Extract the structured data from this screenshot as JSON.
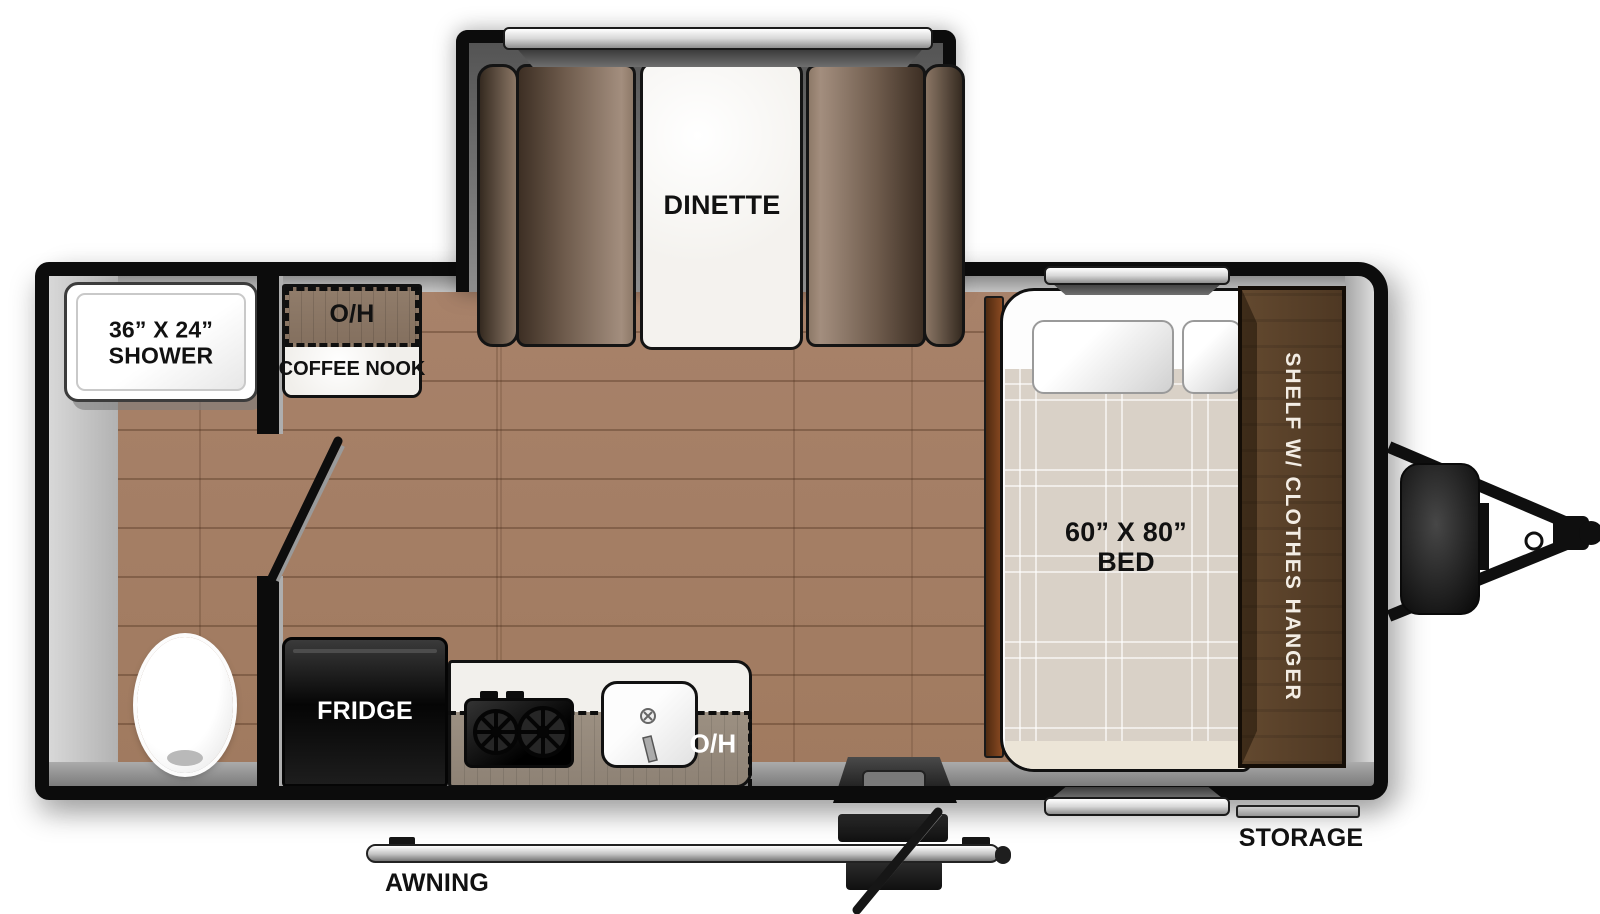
{
  "floorplan": {
    "slideout": {
      "dinette_label": "DINETTE"
    },
    "bathroom": {
      "shower_size": "36” X 24”",
      "shower_label": "SHOWER"
    },
    "coffee_nook": {
      "oh_label": "O/H",
      "label": "COFFEE NOOK"
    },
    "kitchen": {
      "fridge_label": "FRIDGE",
      "oh_label": "O/H"
    },
    "bedroom": {
      "bed_size": "60” X 80”",
      "bed_label": "BED",
      "shelf_label": "SHELF W/ CLOTHES HANGER",
      "storage_label": "STORAGE"
    },
    "exterior": {
      "awning_label": "AWNING"
    }
  },
  "colors": {
    "wall": "#0c0c0c",
    "floor_wood": "#a8826a",
    "table_marble": "#f4f2ee",
    "bench_brown": "#8a7665",
    "cabinet_brown": "#5a4129",
    "bed_plaid": "#d9d1c7",
    "counter_wood": "#9c9082",
    "nook_wood": "#8b7765",
    "lining_gray": "#bdbdbd",
    "entry_granite": "#8f8f8f",
    "window_silver": "#d8d8d8"
  }
}
